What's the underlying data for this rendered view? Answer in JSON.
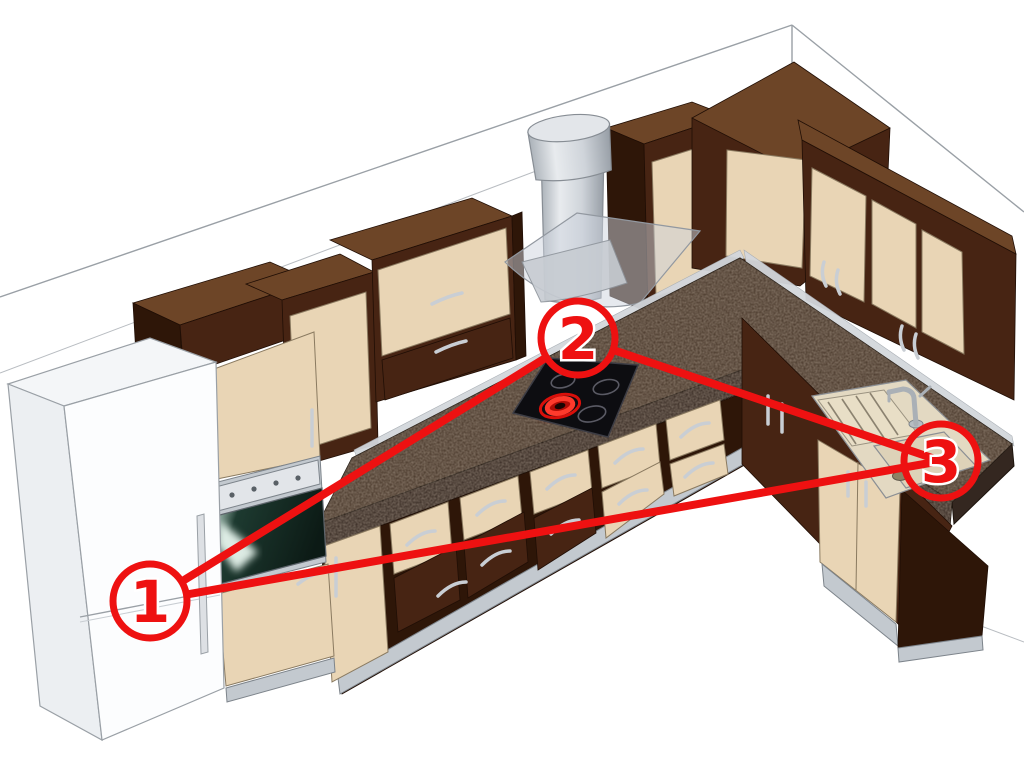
{
  "canvas": {
    "width": 1024,
    "height": 768,
    "background": "#ffffff"
  },
  "overlay": {
    "color": "#ee1111",
    "line_width": 8,
    "circle_radius": 37,
    "circle_stroke_width": 7,
    "label_font_size": 58,
    "label_halo_color": "#ffffff",
    "markers": [
      {
        "label": "1",
        "x": 150,
        "y": 601,
        "points_at": "refrigerator"
      },
      {
        "label": "2",
        "x": 578,
        "y": 338,
        "points_at": "cooktop"
      },
      {
        "label": "3",
        "x": 941,
        "y": 461,
        "points_at": "sink"
      }
    ],
    "lines": [
      {
        "from": 0,
        "to": 1,
        "trim_from": true,
        "trim_to": true
      },
      {
        "from": 1,
        "to": 2,
        "trim_from": true,
        "trim_to": false
      },
      {
        "from": 0,
        "to": 2,
        "trim_from": true,
        "trim_to": false
      }
    ]
  },
  "scene": {
    "colors": {
      "red": "#ee1111",
      "cream": "#e9d5b5",
      "cream_edge": "#8a7a60",
      "wenge": "#472413",
      "wenge_top": "#6d4527",
      "wenge_dark": "#2e1608",
      "wenge_edge": "#200e05",
      "granite": "#463528",
      "granite_front": "#342720",
      "steel": "#c3c9cf",
      "steel_light": "#e2e5e9",
      "steel_edge": "#7d848b",
      "wall_line": "#9aa0a6",
      "oven_glass": "#0f1d18",
      "sink_body": "#e3d9c2",
      "chrome": "#aab0b6"
    }
  }
}
